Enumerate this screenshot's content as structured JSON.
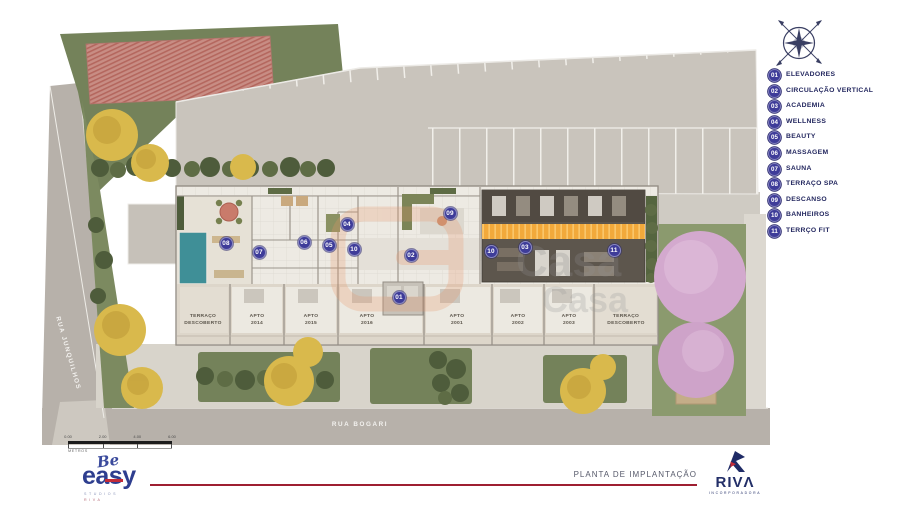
{
  "plan": {
    "streets": {
      "left": "RUA JUNQUILHOS",
      "bottom": "RUA BOGARI"
    },
    "markers": [
      {
        "label": "01",
        "x": 399,
        "y": 297
      },
      {
        "label": "02",
        "x": 411,
        "y": 255
      },
      {
        "label": "03",
        "x": 525,
        "y": 247
      },
      {
        "label": "04",
        "x": 347,
        "y": 224
      },
      {
        "label": "05",
        "x": 329,
        "y": 245
      },
      {
        "label": "06",
        "x": 304,
        "y": 242
      },
      {
        "label": "07",
        "x": 259,
        "y": 252
      },
      {
        "label": "08",
        "x": 226,
        "y": 243
      },
      {
        "label": "09",
        "x": 450,
        "y": 213
      },
      {
        "label": "10",
        "x": 354,
        "y": 249
      },
      {
        "label": "10",
        "x": 491,
        "y": 251
      },
      {
        "label": "11",
        "x": 614,
        "y": 250
      }
    ],
    "apartments": [
      {
        "line1": "TERRAÇO",
        "line2": "DESCOBERTO",
        "x": 203
      },
      {
        "line1": "APTO",
        "line2": "2014",
        "x": 257
      },
      {
        "line1": "APTO",
        "line2": "2015",
        "x": 311
      },
      {
        "line1": "APTO",
        "line2": "2016",
        "x": 367
      },
      {
        "line1": "APTO",
        "line2": "2001",
        "x": 457
      },
      {
        "line1": "APTO",
        "line2": "2002",
        "x": 518
      },
      {
        "line1": "APTO",
        "line2": "2003",
        "x": 569
      },
      {
        "line1": "TERRAÇO",
        "line2": "DESCOBERTO",
        "x": 626
      }
    ]
  },
  "legend": {
    "items": [
      {
        "num": "01",
        "label": "ELEVADORES"
      },
      {
        "num": "02",
        "label": "CIRCULAÇÃO VERTICAL"
      },
      {
        "num": "03",
        "label": "ACADEMIA"
      },
      {
        "num": "04",
        "label": "WELLNESS"
      },
      {
        "num": "05",
        "label": "BEAUTY"
      },
      {
        "num": "06",
        "label": "MASSAGEM"
      },
      {
        "num": "07",
        "label": "SAUNA"
      },
      {
        "num": "08",
        "label": "TERRAÇO SPA"
      },
      {
        "num": "09",
        "label": "DESCANSO"
      },
      {
        "num": "10",
        "label": "BANHEIROS"
      },
      {
        "num": "11",
        "label": "TERRÇO FIT"
      }
    ]
  },
  "scalebar": {
    "ticks": [
      "0.00",
      "2.00",
      "4.00",
      "6.00"
    ],
    "unit": "METROS"
  },
  "footer": {
    "title": "PLANTA DE IMPLANTAÇÃO",
    "brand": {
      "script": "Be",
      "word": "easy",
      "sub1": "STUDIOS",
      "sub2": "RIVA"
    },
    "riva": {
      "word": "RIVΛ",
      "sub": "INCORPORADORA"
    }
  },
  "watermark": {
    "text": "Casa"
  },
  "colors": {
    "marker": "#3E3C99",
    "legend_navy": "#23275F",
    "track_yellow": "#F2A93B",
    "brand_blue": "#2E3E8F",
    "brand_red": "#A01E31",
    "pool_teal": "#3F8F97",
    "tree_pink": "#D3A9CE",
    "grass": "#74825A",
    "street": "#B7B1AA"
  }
}
